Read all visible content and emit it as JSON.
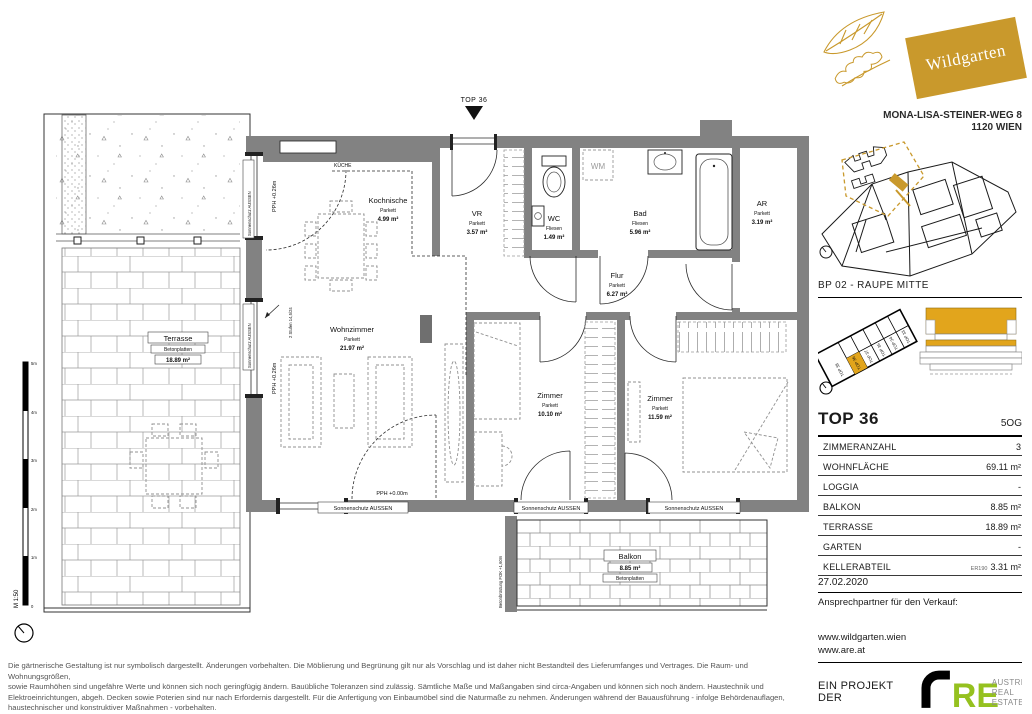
{
  "colors": {
    "gold": "#C9992C",
    "gold_bright": "#E2A51C",
    "are_green": "#95C11F",
    "wall_gray": "#828282"
  },
  "brand": {
    "name": "Wildgarten"
  },
  "address": {
    "line1": "MONA-LISA-STEINER-WEG 8",
    "line2": "1120 WIEN"
  },
  "site_plan": {
    "label": "BP 02 - RAUPE MITTE"
  },
  "key_plan": {
    "units": [
      "TOP 38",
      "TOP 36",
      "TOP 37",
      "TOP 35",
      "TOP 34",
      "TOP 33"
    ]
  },
  "unit": {
    "id": "TOP 36",
    "floor": "5OG",
    "rows": [
      {
        "label": "ZIMMERANZAHL",
        "value": "3",
        "prefix": ""
      },
      {
        "label": "WOHNFLÄCHE",
        "value": "69.11 m²",
        "prefix": ""
      },
      {
        "label": "LOGGIA",
        "value": "-",
        "prefix": ""
      },
      {
        "label": "BALKON",
        "value": "8.85 m²",
        "prefix": ""
      },
      {
        "label": "TERRASSE",
        "value": "18.89 m²",
        "prefix": ""
      },
      {
        "label": "GARTEN",
        "value": "-",
        "prefix": ""
      },
      {
        "label": "KELLERABTEIL",
        "value": "3.31 m²",
        "prefix": "ER190"
      }
    ]
  },
  "sales": {
    "date": "27.02.2020",
    "contact_label": "Ansprechpartner für den Verkauf:",
    "website1": "www.wildgarten.wien",
    "website2": "www.are.at"
  },
  "project": {
    "label": "EIN PROJEKT DER",
    "logo_text": "RE",
    "caption": [
      "AUSTRIAN",
      "REAL",
      "ESTATE"
    ]
  },
  "plan": {
    "entrance_label": "TOP 36",
    "rooms": {
      "kueche": "KÜCHE",
      "kochnische": {
        "name": "Kochnische",
        "finish": "Parkett",
        "area": "4.99 m²"
      },
      "vr": {
        "name": "VR",
        "finish": "Parkett",
        "area": "3.57 m²"
      },
      "wc": {
        "name": "WC",
        "finish": "Fliesen",
        "area": "1.49 m²"
      },
      "wm": "WM",
      "bad": {
        "name": "Bad",
        "finish": "Fliesen",
        "area": "5.96 m²"
      },
      "ar": {
        "name": "AR",
        "finish": "Parkett",
        "area": "3.19 m²"
      },
      "flur": {
        "name": "Flur",
        "finish": "Parkett",
        "area": "6.27 m²"
      },
      "wohnzimmer": {
        "name": "Wohnzimmer",
        "finish": "Parkett",
        "area": "21.97 m²"
      },
      "zimmer1": {
        "name": "Zimmer",
        "finish": "Parkett",
        "area": "10.10 m²"
      },
      "zimmer2": {
        "name": "Zimmer",
        "finish": "Parkett",
        "area": "11.59 m²"
      },
      "terrasse": {
        "name": "Terrasse",
        "finish": "Betonplatten",
        "area": "18.89 m²"
      },
      "balkon": {
        "name": "Balkon",
        "area": "8.85 m²",
        "finish": "Betonplatten"
      }
    },
    "annotations": {
      "sonnenschutz": "Sonnenschutz AUSSEN",
      "pph_026": "PPH +0.26m",
      "pph_000": "PPH +0.00m",
      "stufen": "2 Stufen 14,5/24",
      "bruestung": "Betonbrüstung FOK +1,60m"
    }
  },
  "scalebar": {
    "marks": [
      "5m",
      "4m",
      "3m",
      "2m",
      "1m",
      "0"
    ],
    "label": "M 1:50"
  },
  "disclaimer": {
    "lines": [
      "Die gärtnerische Gestaltung ist nur symbolisch dargestellt. Änderungen vorbehalten. Die Möblierung und Begrünung gilt nur als Vorschlag und ist daher nicht Bestandteil des Lieferumfanges und Vertrages. Die Raum- und Wohnungsgrößen,",
      "sowie Raumhöhen sind ungefähre Werte und können sich noch geringfügig ändern. Bauübliche Toleranzen sind zulässig. Sämtliche Maße und Maßangaben sind circa-Angaben und können sich noch ändern. Haustechnik und",
      "Elektroeinrichtungen, abgeh. Decken sowie Poterien sind nur nach Erfordernis dargestellt. Für die Anfertigung von Einbaumöbel sind die Naturmaße zu nehmen. Änderungen während der Bauausführung - infolge Behördenauflagen,",
      "haustechnischer und konstruktiver Maßnahmen - vorbehalten."
    ]
  }
}
